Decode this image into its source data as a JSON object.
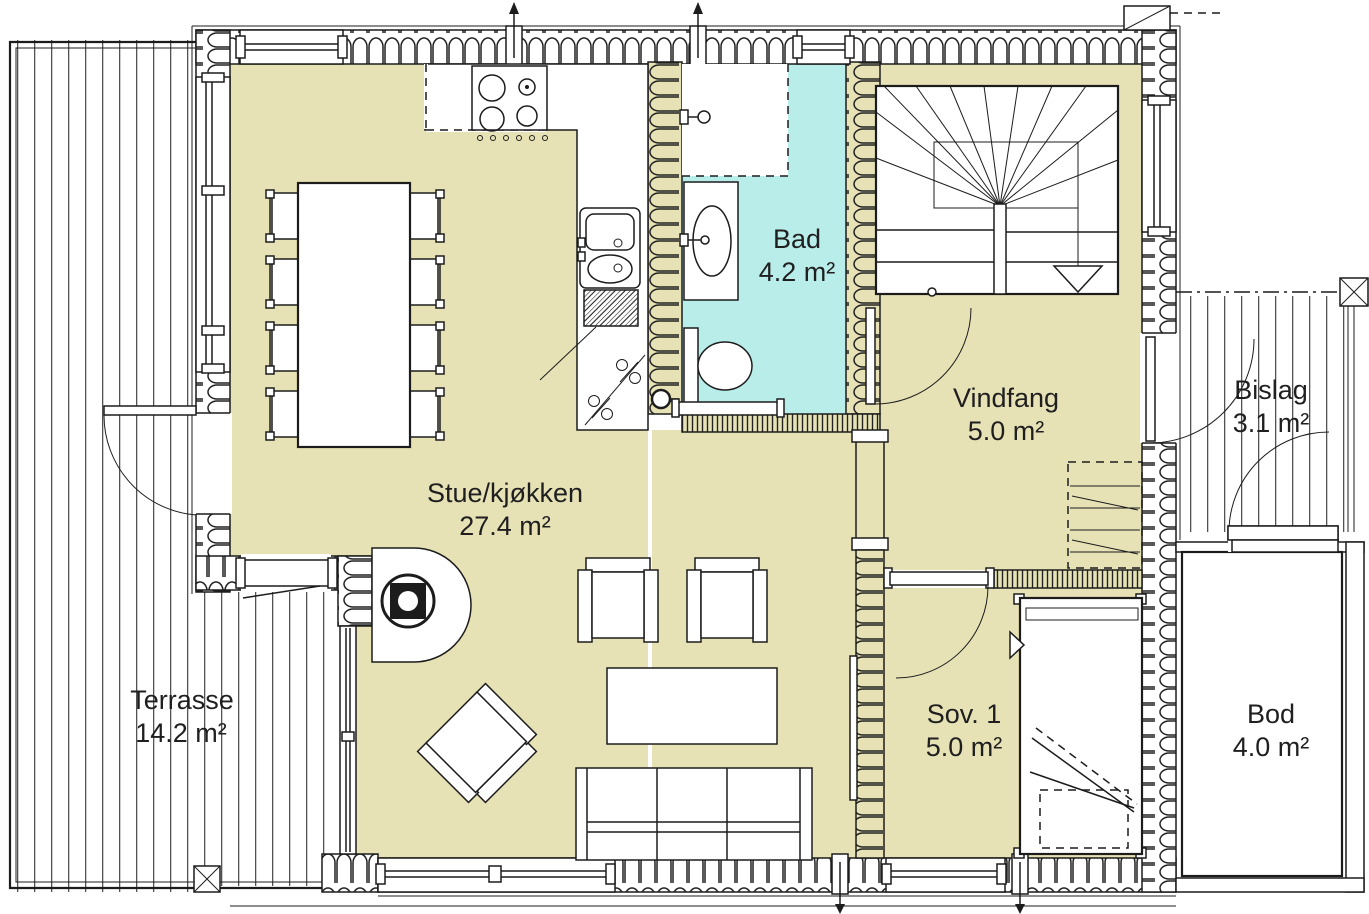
{
  "drawing": {
    "type": "architectural-floor-plan",
    "units": "m²"
  },
  "colors": {
    "floor": "#e6e2b6",
    "bath": "#b9edea",
    "wall_line": "#1c1c1c"
  },
  "rooms": [
    {
      "id": "stue",
      "name": "Stue/kjøkken",
      "area": "27.4 m²"
    },
    {
      "id": "bad",
      "name": "Bad",
      "area": "4.2 m²"
    },
    {
      "id": "vindfang",
      "name": "Vindfang",
      "area": "5.0 m²"
    },
    {
      "id": "bislag",
      "name": "Bislag",
      "area": "3.1 m²"
    },
    {
      "id": "sov1",
      "name": "Sov. 1",
      "area": "5.0 m²"
    },
    {
      "id": "bod",
      "name": "Bod",
      "area": "4.0 m²"
    },
    {
      "id": "terrasse",
      "name": "Terrasse",
      "area": "14.2 m²"
    }
  ]
}
